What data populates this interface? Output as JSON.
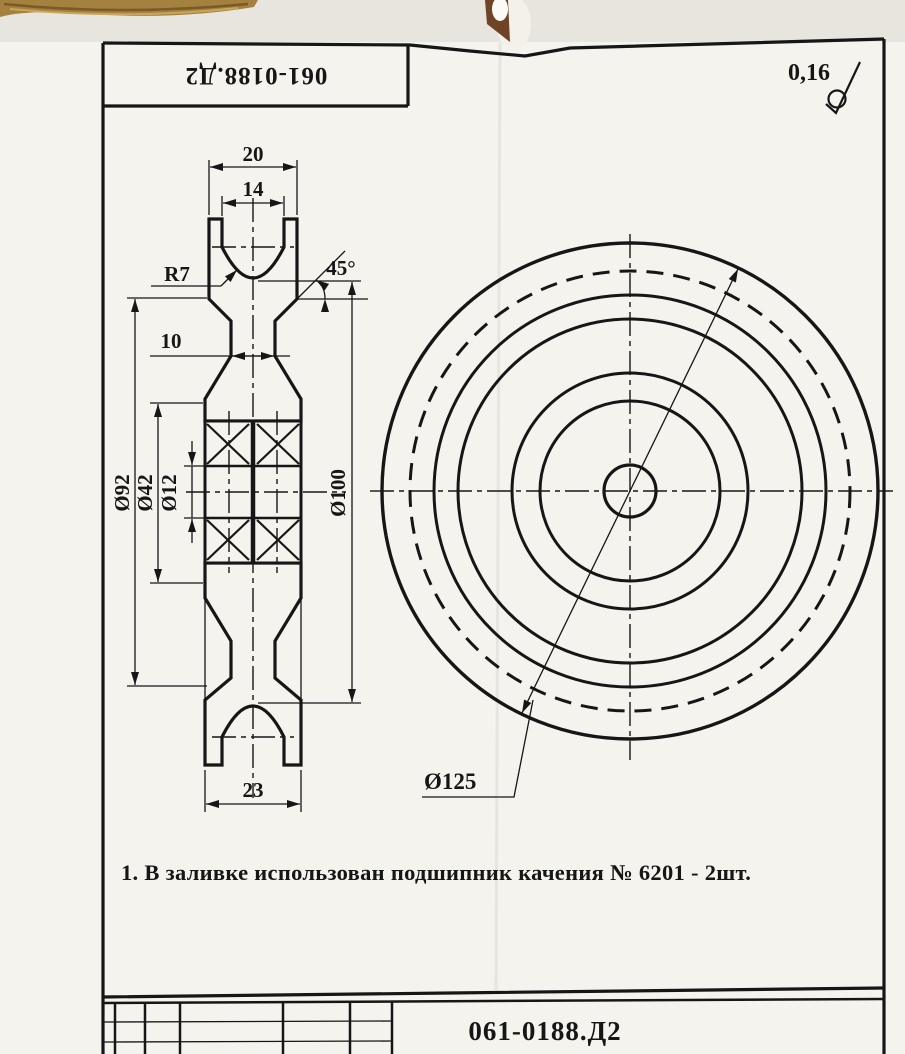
{
  "page": {
    "paper_color": "#f5f3ee",
    "ink_color": "#161616",
    "section_fill": "#b1afb0"
  },
  "top_stamp": {
    "code": "061-0188.Д2"
  },
  "roughness": {
    "value": "0,16"
  },
  "section_view": {
    "width_top": "20",
    "groove_width": "14",
    "groove_radius": "R7",
    "chamfer_angle": "45°",
    "web_width": "10",
    "dia_flange": "Ø92",
    "dia_hub": "Ø42",
    "dia_bore": "Ø12",
    "dia_groove": "Ø100",
    "width_bottom": "23"
  },
  "front_view": {
    "dia_outer": "Ø125"
  },
  "notes": [
    "1. В заливке использован подшипник качения № 6201 - 2шт."
  ],
  "title_block": {
    "code": "061-0188.Д2"
  }
}
